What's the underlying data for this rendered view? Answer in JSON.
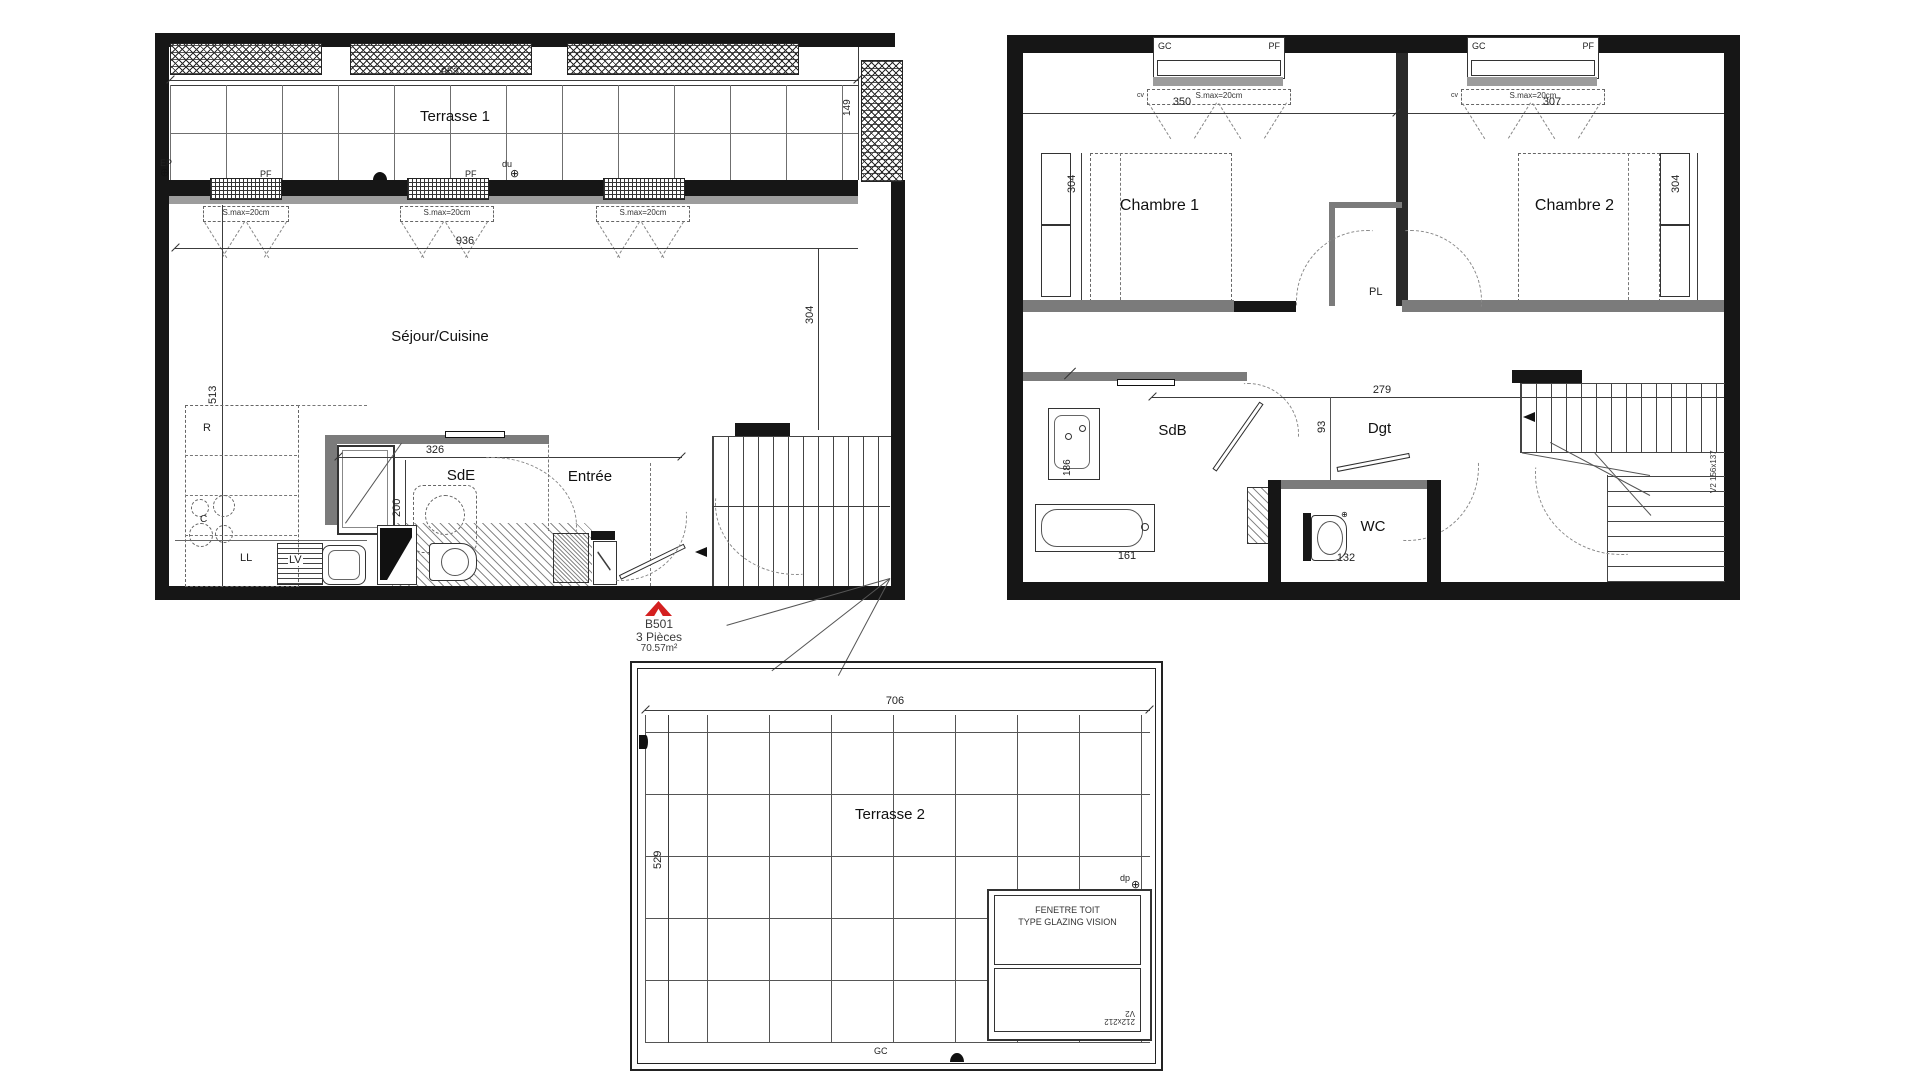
{
  "ground": {
    "title": "Terrasse 1",
    "living": "Séjour/Cuisine",
    "sde": "SdE",
    "entry": "Entrée",
    "dims": {
      "d953": "953",
      "d149": "149",
      "d936": "936",
      "d304": "304",
      "d513": "513",
      "d326": "326",
      "d200": "200"
    },
    "tags": {
      "ep": "EP",
      "pf": "PF",
      "du": "du",
      "smax": "S.max=20cm",
      "r": "R",
      "c": "C",
      "ll": "LL",
      "lv": "LV"
    }
  },
  "unit": {
    "code": "B501",
    "type": "3 Pièces",
    "area": "70.57m²"
  },
  "upper": {
    "chambre1": "Chambre 1",
    "chambre2": "Chambre 2",
    "sdb": "SdB",
    "dgt": "Dgt",
    "wc": "WC",
    "pl": "PL",
    "dims": {
      "d350": "350",
      "d307": "307",
      "d304": "304",
      "d279": "279",
      "d93": "93",
      "d186": "186",
      "d161": "161",
      "d132": "132"
    },
    "tags": {
      "gc": "GC",
      "pf": "PF",
      "cv": "cv",
      "smax": "S.max=20cm",
      "stair": "V2 156x137"
    }
  },
  "roof": {
    "title": "Terrasse 2",
    "dims": {
      "d706": "706",
      "d529": "529"
    },
    "tags": {
      "gc": "GC",
      "dp": "dp"
    },
    "skylight": {
      "line1": "FENETRE TOIT",
      "line2": "TYPE GLAZING VISION",
      "size": "212x212",
      "code": "V2"
    }
  }
}
